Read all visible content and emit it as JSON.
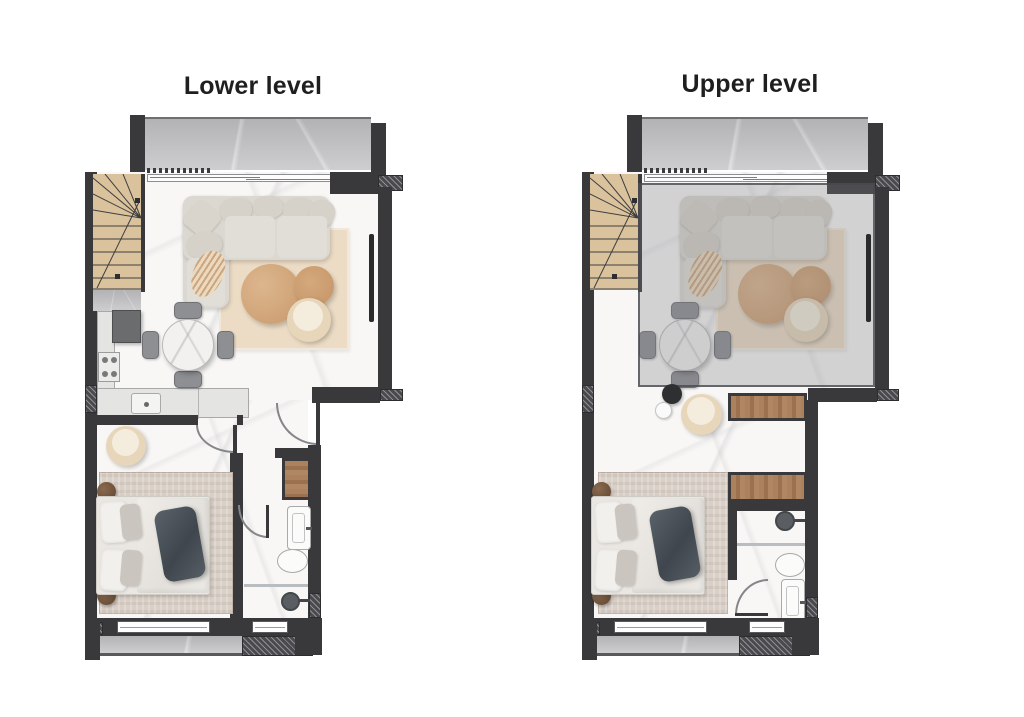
{
  "page": {
    "background": "#ffffff"
  },
  "plans": [
    {
      "id": "lower",
      "title": "Lower level"
    },
    {
      "id": "upper",
      "title": "Upper level"
    }
  ],
  "colors": {
    "wall": "#39393b",
    "wall-hatch": "#4a4a4e",
    "floor": "#f8f7f5",
    "balcony": "#c7c7c9",
    "stair-wood": "#dac29c",
    "closet-wood": "#a37a57",
    "rug-living": "#ecdcc5",
    "rug-bedroom": "#d9d0c8",
    "sofa": "#dbd8d1",
    "coffee-table": "#d2a87b",
    "armchair": "#e7d6ba",
    "bed-linen": "#eae7e3",
    "bed-throw": "#4e555c",
    "dining-chair": "#8d8f92",
    "title-text": "#1f1f1f"
  }
}
